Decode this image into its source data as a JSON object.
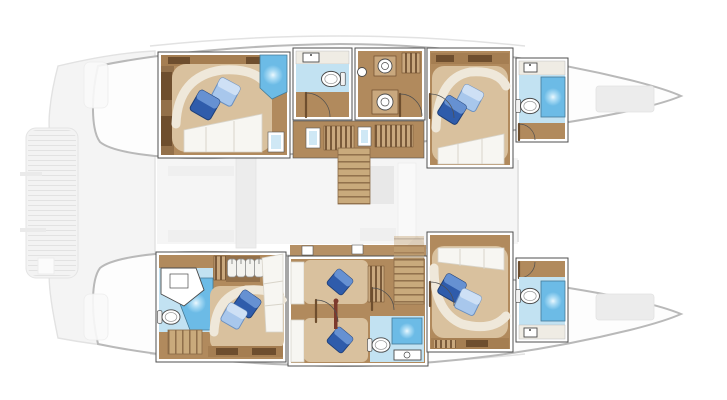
{
  "colors": {
    "background": "#ffffff",
    "hull_outline": "#b9b9b9",
    "hull_fill": "#fdfdfd",
    "deck_fill": "#f4f4f4",
    "deck_line": "#e2e2e2",
    "deck_shape": "#ececec",
    "wall": "#4f4f4f",
    "wall_white": "#ffffff",
    "wood": "#b18a5d",
    "wood_dark": "#93704a",
    "wood_shelf": "#a57e52",
    "cabinet_dark": "#6e4e2e",
    "stripe_light": "#c9a87e",
    "bed_base": "#d9c19e",
    "bed_curve": "#efe8da",
    "linen": "#f7f6f2",
    "linen_line": "#d8d4ca",
    "pillow_dark": "#2f5cab",
    "pillow_dark_hi": "#6d97d6",
    "pillow_light": "#a8c7ec",
    "pillow_light_hi": "#d2e2f6",
    "bath_floor": "#c2e2f2",
    "shower": "#6cbbe6",
    "shower_glow": "#eaf8ff",
    "fixture": "#ffffff",
    "fixture_line": "#4a4a4a",
    "ladder_red": "#7c3a2c"
  },
  "plan": {
    "vessel_type": "catamaran",
    "view": "top-down lower-deck accommodation plan",
    "bow_direction": "right",
    "port_hull_rooms": [
      {
        "id": "port-aft-cabin",
        "type": "double-cabin",
        "fixtures": [
          "double-bed",
          "dark-pillow",
          "light-pillow",
          "wardrobe",
          "shelf",
          "corner-shower",
          "hull-window"
        ]
      },
      {
        "id": "port-aft-bathroom",
        "type": "bathroom",
        "fixtures": [
          "washbasin-counter",
          "toilet",
          "door"
        ]
      },
      {
        "id": "port-utility",
        "type": "utility-area",
        "fixtures": [
          "washer",
          "dryer",
          "round-basin",
          "cabinet",
          "door"
        ]
      },
      {
        "id": "port-corridor",
        "type": "corridor",
        "fixtures": [
          "hull-windows",
          "cabinets",
          "staircase"
        ]
      },
      {
        "id": "port-forward-cabin",
        "type": "double-cabin",
        "fixtures": [
          "double-bed",
          "dark-pillow",
          "light-pillow",
          "shelf",
          "door"
        ]
      },
      {
        "id": "port-forward-bathroom",
        "type": "bathroom",
        "fixtures": [
          "washbasin-counter",
          "toilet",
          "shower",
          "door"
        ]
      }
    ],
    "starboard_hull_rooms": [
      {
        "id": "starboard-aft-cabin",
        "type": "double-cabin-ensuite",
        "fixtures": [
          "double-bed",
          "dark-pillow",
          "light-pillow",
          "washbasin-counter",
          "toilet",
          "shower",
          "hanging-lockers",
          "wardrobe",
          "stairs",
          "shelf"
        ]
      },
      {
        "id": "starboard-twin-cabin",
        "type": "twin-cabin",
        "fixtures": [
          "single-bed",
          "single-bed",
          "dark-pillow",
          "dark-pillow",
          "ladder",
          "staircase"
        ]
      },
      {
        "id": "starboard-mid-bathroom",
        "type": "bathroom",
        "fixtures": [
          "toilet",
          "shower",
          "washbasin-counter"
        ]
      },
      {
        "id": "starboard-forward-cabin",
        "type": "double-cabin",
        "fixtures": [
          "double-bed",
          "dark-pillow",
          "light-pillow",
          "bookshelf",
          "door"
        ]
      },
      {
        "id": "starboard-forward-bathroom",
        "type": "bathroom",
        "fixtures": [
          "washbasin-counter",
          "toilet",
          "shower",
          "door"
        ]
      }
    ],
    "deck_features": [
      "aft-swim-platform",
      "aft-cockpit-seats",
      "saloon-table-and-sofa",
      "galley-counter",
      "bow-deck-hatches"
    ],
    "fixture_counts": {
      "double_beds": 4,
      "single_beds": 2,
      "bathrooms": 5,
      "showers": 5,
      "toilets": 5,
      "staircases": 3,
      "blue_pillows": 10
    }
  }
}
